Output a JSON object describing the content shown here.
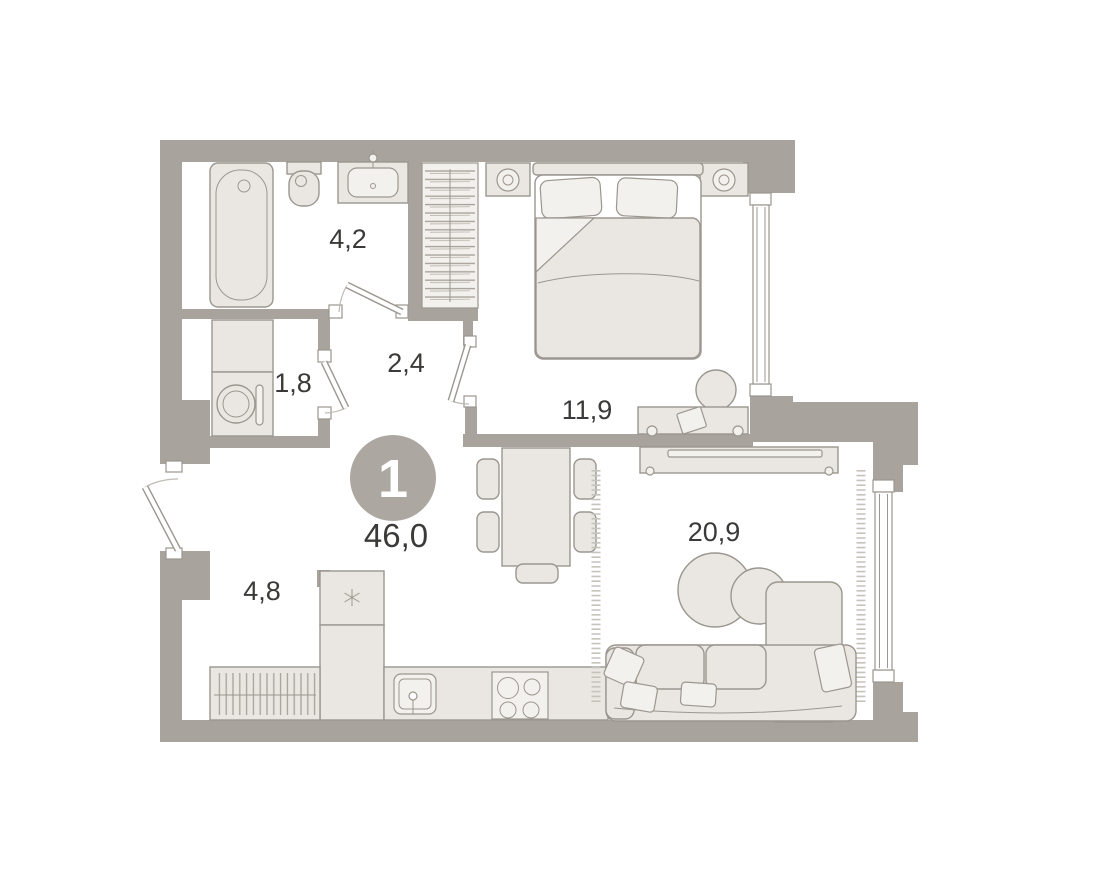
{
  "plan_title": "1-room apartment floor plan",
  "badge": {
    "unit_rooms": "1",
    "total_area": "46,0"
  },
  "rooms": {
    "bathroom": {
      "area": "4,2"
    },
    "utility": {
      "area": "1,8"
    },
    "hallway": {
      "area": "2,4"
    },
    "bedroom": {
      "area": "11,9"
    },
    "entry": {
      "area": "4,8"
    },
    "living_kitchen": {
      "area": "20,9"
    }
  },
  "colors": {
    "wall": "#a8a39c",
    "furniture": "#eae7e2",
    "furniture_light": "#f3f1ed",
    "bed_sheet": "#ffffff",
    "stroke": "#9b968f",
    "text": "#3b3a38",
    "badge": "#aca7a1",
    "door_arc": "#bfbbb5",
    "fringe": "#c6c2bc",
    "background": "#ffffff"
  }
}
